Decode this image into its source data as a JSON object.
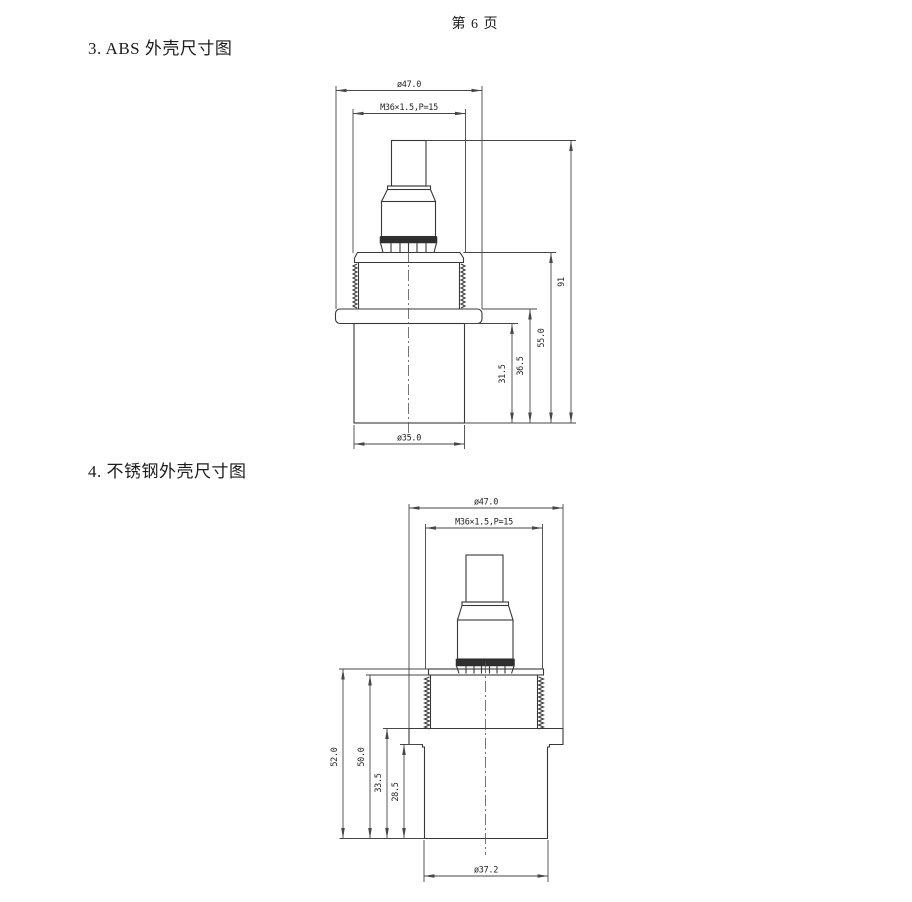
{
  "page": {
    "number_label": "第 6 页"
  },
  "section_abs": {
    "title": "3. ABS 外壳尺寸图"
  },
  "section_steel": {
    "title": "4. 不锈钢外壳尺寸图"
  },
  "drawing_abs": {
    "flange_diameter": "ø47.0",
    "thread_spec": "M36×1.5,P=15",
    "overall_height": "91",
    "height_plate_to_bottom": "55.0",
    "height_flange_top_to_bottom": "36.5",
    "lower_body_height": "31.5",
    "bottom_diameter": "ø35.0"
  },
  "drawing_steel": {
    "flange_diameter": "ø47.0",
    "thread_spec": "M36×1.5,P=15",
    "height_plate_to_bottom": "52.0",
    "height_below_plate": "50.0",
    "height_shoulder_to_bottom": "33.5",
    "lower_body_height": "28.5",
    "bottom_diameter": "ø37.2"
  },
  "colors": {
    "ink": "#383838",
    "dim_ink": "#474747",
    "background": "#ffffff"
  }
}
